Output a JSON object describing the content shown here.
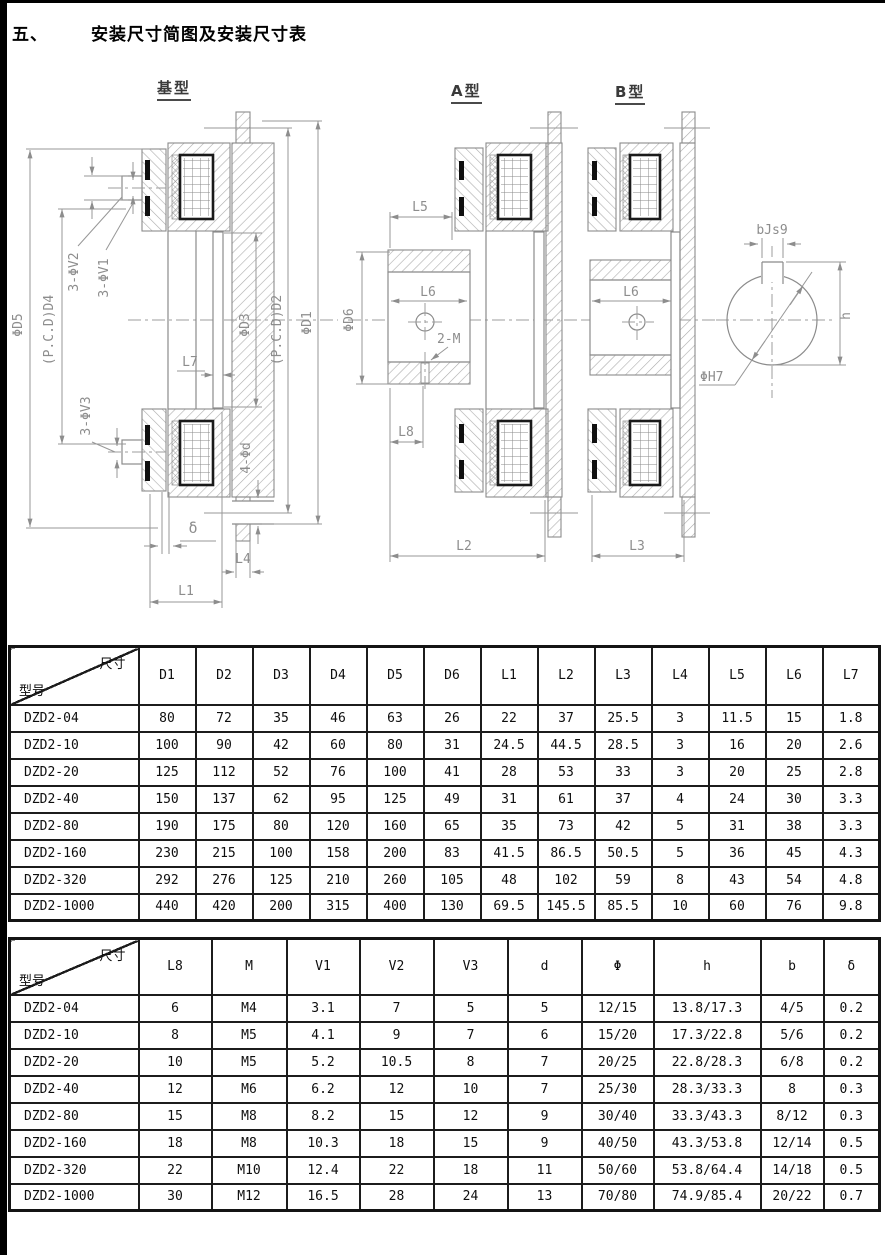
{
  "page": {
    "section_number": "五、",
    "title": "安装尺寸简图及安装尺寸表"
  },
  "drawings": {
    "base": {
      "title": "基型",
      "labels": {
        "d5": "ΦD5",
        "d4": "(P.C.D)D4",
        "v2": "3-ΦV2",
        "v1": "3-ΦV1",
        "d3": "ΦD3",
        "d2": "(P.C.D)D2",
        "d1": "ΦD1",
        "l7": "L7",
        "v3": "3-ΦV3",
        "d": "4-Φd",
        "delta": "δ",
        "l4": "L4",
        "l1": "L1"
      }
    },
    "typeA": {
      "title": "A型",
      "labels": {
        "l5": "L5",
        "l6": "L6",
        "d6": "ΦD6",
        "m": "2-M",
        "l8": "L8",
        "l2": "L2"
      }
    },
    "typeB": {
      "title": "B型",
      "labels": {
        "l6": "L6",
        "l3": "L3"
      }
    },
    "keyway": {
      "labels": {
        "b": "bJs9",
        "h": "h",
        "phi": "ΦH7"
      }
    }
  },
  "table1": {
    "corner": {
      "top": "尺寸",
      "bottom": "型号"
    },
    "columns": [
      "D1",
      "D2",
      "D3",
      "D4",
      "D5",
      "D6",
      "L1",
      "L2",
      "L3",
      "L4",
      "L5",
      "L6",
      "L7"
    ],
    "rows": [
      {
        "model": "DZD2-04",
        "values": [
          "80",
          "72",
          "35",
          "46",
          "63",
          "26",
          "22",
          "37",
          "25.5",
          "3",
          "11.5",
          "15",
          "1.8"
        ]
      },
      {
        "model": "DZD2-10",
        "values": [
          "100",
          "90",
          "42",
          "60",
          "80",
          "31",
          "24.5",
          "44.5",
          "28.5",
          "3",
          "16",
          "20",
          "2.6"
        ]
      },
      {
        "model": "DZD2-20",
        "values": [
          "125",
          "112",
          "52",
          "76",
          "100",
          "41",
          "28",
          "53",
          "33",
          "3",
          "20",
          "25",
          "2.8"
        ]
      },
      {
        "model": "DZD2-40",
        "values": [
          "150",
          "137",
          "62",
          "95",
          "125",
          "49",
          "31",
          "61",
          "37",
          "4",
          "24",
          "30",
          "3.3"
        ]
      },
      {
        "model": "DZD2-80",
        "values": [
          "190",
          "175",
          "80",
          "120",
          "160",
          "65",
          "35",
          "73",
          "42",
          "5",
          "31",
          "38",
          "3.3"
        ]
      },
      {
        "model": "DZD2-160",
        "values": [
          "230",
          "215",
          "100",
          "158",
          "200",
          "83",
          "41.5",
          "86.5",
          "50.5",
          "5",
          "36",
          "45",
          "4.3"
        ]
      },
      {
        "model": "DZD2-320",
        "values": [
          "292",
          "276",
          "125",
          "210",
          "260",
          "105",
          "48",
          "102",
          "59",
          "8",
          "43",
          "54",
          "4.8"
        ]
      },
      {
        "model": "DZD2-1000",
        "values": [
          "440",
          "420",
          "200",
          "315",
          "400",
          "130",
          "69.5",
          "145.5",
          "85.5",
          "10",
          "60",
          "76",
          "9.8"
        ]
      }
    ]
  },
  "table2": {
    "corner": {
      "top": "尺寸",
      "bottom": "型号"
    },
    "columns": [
      "L8",
      "M",
      "V1",
      "V2",
      "V3",
      "d",
      "Φ",
      "h",
      "b",
      "δ"
    ],
    "rows": [
      {
        "model": "DZD2-04",
        "values": [
          "6",
          "M4",
          "3.1",
          "7",
          "5",
          "5",
          "12/15",
          "13.8/17.3",
          "4/5",
          "0.2"
        ]
      },
      {
        "model": "DZD2-10",
        "values": [
          "8",
          "M5",
          "4.1",
          "9",
          "7",
          "6",
          "15/20",
          "17.3/22.8",
          "5/6",
          "0.2"
        ]
      },
      {
        "model": "DZD2-20",
        "values": [
          "10",
          "M5",
          "5.2",
          "10.5",
          "8",
          "7",
          "20/25",
          "22.8/28.3",
          "6/8",
          "0.2"
        ]
      },
      {
        "model": "DZD2-40",
        "values": [
          "12",
          "M6",
          "6.2",
          "12",
          "10",
          "7",
          "25/30",
          "28.3/33.3",
          "8",
          "0.3"
        ]
      },
      {
        "model": "DZD2-80",
        "values": [
          "15",
          "M8",
          "8.2",
          "15",
          "12",
          "9",
          "30/40",
          "33.3/43.3",
          "8/12",
          "0.3"
        ]
      },
      {
        "model": "DZD2-160",
        "values": [
          "18",
          "M8",
          "10.3",
          "18",
          "15",
          "9",
          "40/50",
          "43.3/53.8",
          "12/14",
          "0.5"
        ]
      },
      {
        "model": "DZD2-320",
        "values": [
          "22",
          "M10",
          "12.4",
          "22",
          "18",
          "11",
          "50/60",
          "53.8/64.4",
          "14/18",
          "0.5"
        ]
      },
      {
        "model": "DZD2-1000",
        "values": [
          "30",
          "M12",
          "16.5",
          "28",
          "24",
          "13",
          "70/80",
          "74.9/85.4",
          "20/22",
          "0.7"
        ]
      }
    ]
  }
}
